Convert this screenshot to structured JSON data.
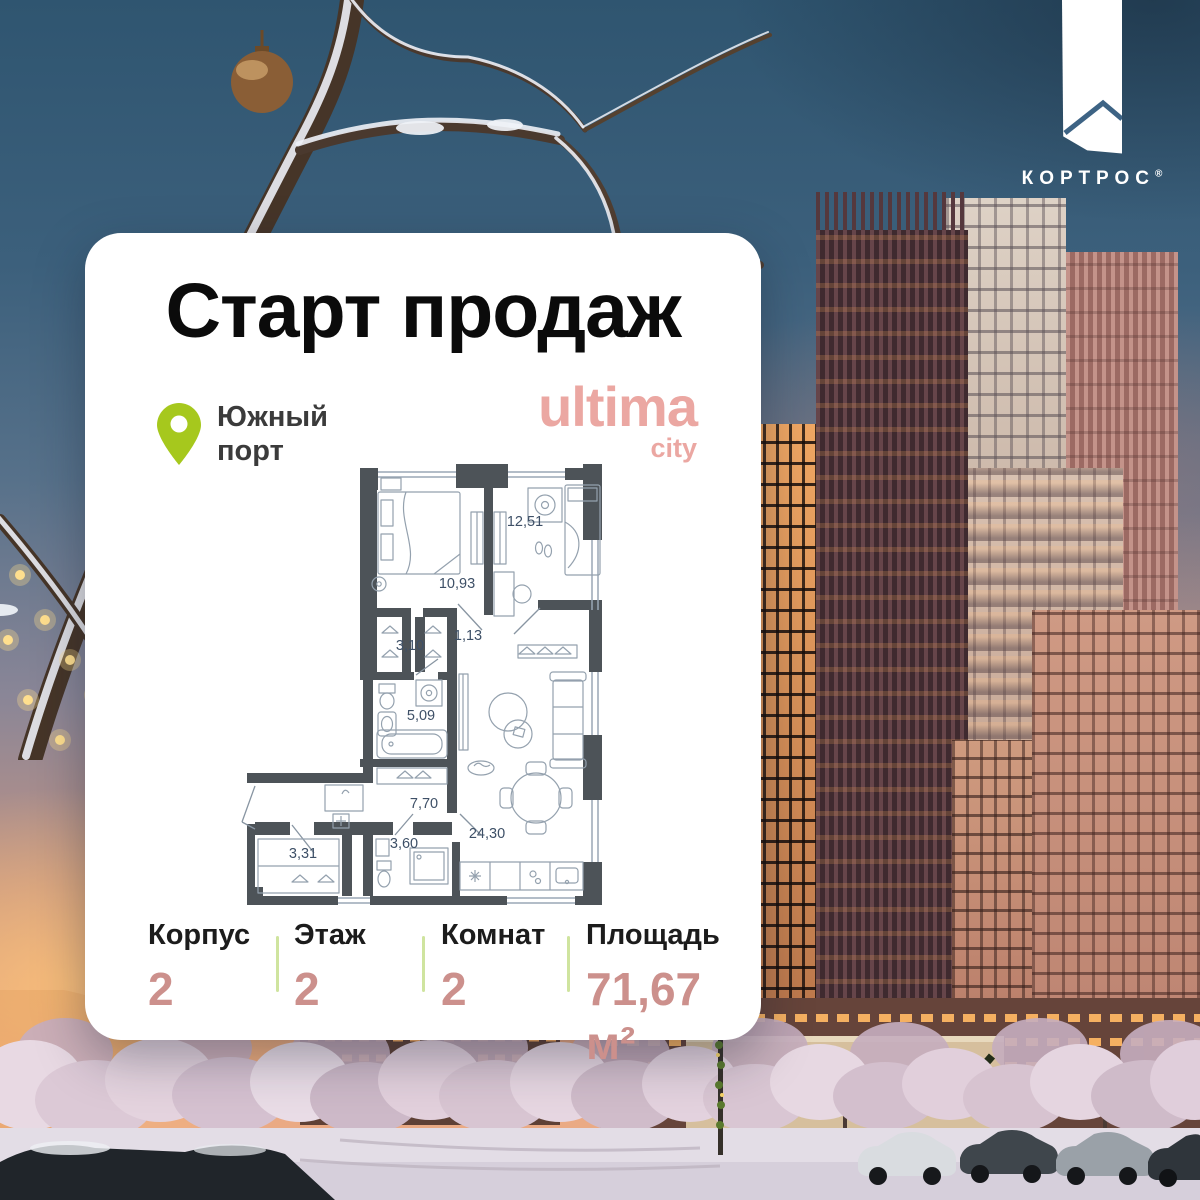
{
  "brand": {
    "name": "КОРТРОС",
    "registered": "®"
  },
  "card": {
    "title": "Старт продаж",
    "location": {
      "line1": "Южный",
      "line2": "порт"
    },
    "project": {
      "name": "ultima",
      "tagline": "city"
    },
    "stats": [
      {
        "label": "Корпус",
        "value": "2"
      },
      {
        "label": "Этаж",
        "value": "2"
      },
      {
        "label": "Комнат",
        "value": "2"
      },
      {
        "label": "Площадь",
        "value": "71,67 м²"
      }
    ]
  },
  "floor_plan": {
    "rooms": [
      {
        "id": "bedroom-1",
        "area": "10,93"
      },
      {
        "id": "bedroom-2",
        "area": "12,51"
      },
      {
        "id": "closet",
        "area": "3,10"
      },
      {
        "id": "hall",
        "area": "1,13"
      },
      {
        "id": "bathroom",
        "area": "5,09"
      },
      {
        "id": "corridor",
        "area": "7,70"
      },
      {
        "id": "wardrobe-room",
        "area": "3,31"
      },
      {
        "id": "wc",
        "area": "3,60"
      },
      {
        "id": "living-kitchen",
        "area": "24,30"
      }
    ]
  },
  "colors": {
    "brand_pink": "#eba7a2",
    "value_rose": "#cc908c",
    "pin_green": "#a6c81d",
    "divider_green": "#cfe49f",
    "plan_wall": "#4d5358",
    "plan_label": "#3e5067"
  }
}
